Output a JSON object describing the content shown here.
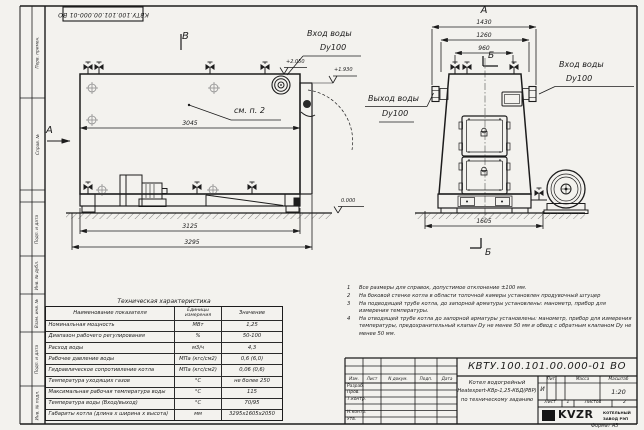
{
  "stamp": {
    "code": "КВТУ.100.101.00.000-01 ВО"
  },
  "margin_labels": {
    "perv_primen": "Перв. примен.",
    "sprav_no": "Справ. №",
    "podp_data1": "Подп. и дата",
    "inv_dubl": "Инв. № дубл.",
    "vzam_inv": "Взам. инв. №",
    "podp_data2": "Подп. и дата",
    "inv_podl": "Инв. № подл."
  },
  "drawing": {
    "view_b_label": "В",
    "view_a_label": "А",
    "view_a_arrow_label": "А",
    "section_label_top": "Б",
    "section_label_bottom": "Б",
    "see_note": "см. п. 2",
    "inlet_label": "Вход воды",
    "inlet_dn": "Dy100",
    "outlet_label": "Выход воды",
    "outlet_dn": "Dy100",
    "inlet2_label": "Вход воды",
    "inlet2_dn": "Dy100",
    "elev_inlet": "+2.050",
    "elev_top": "+1.930",
    "elev_ground": "0.000",
    "dims": {
      "side_flange_length": "3045",
      "side_base_length": "3125",
      "side_total_length": "3295",
      "front_total_width": "1430",
      "front_mid_width": "1260",
      "front_inner_width": "960",
      "front_base_width": "1605"
    }
  },
  "notes": [
    {
      "num": "1",
      "text": "Все размеры для справок, допустимое отклонение ±100 мм."
    },
    {
      "num": "2",
      "text": "На боковой стенке котла в области топочной камеры установлен продувочный штуцер"
    },
    {
      "num": "3",
      "text": "На подводящей трубе котла, до запорной арматуры установлены: манометр, прибор для измерения температуры."
    },
    {
      "num": "4",
      "text": "На отводящей трубе котла до запорной арматуры установлены: манометр, прибор для измерения температуры, предохранительный клапан Dу не менее 50 мм и обвод с обратным клапаном Dу не менее 50 мм."
    }
  ],
  "tech_table": {
    "title": "Техническая характеристика",
    "headers": {
      "name": "Наименование показателя",
      "units": "Единицы измерения",
      "value": "Значение"
    },
    "rows": [
      {
        "name": "Номинальная мощность",
        "units": "МВт",
        "value": "1,25"
      },
      {
        "name": "Диапазон рабочего регулирования",
        "units": "%",
        "value": "50-100"
      },
      {
        "name": "Расход воды",
        "units": "м3/ч",
        "value": "4,3"
      },
      {
        "name": "Рабочее давление воды",
        "units": "МПа (кгс/см2)",
        "value": "0,6 (6,0)"
      },
      {
        "name": "Гидравлическое сопротивление котла",
        "units": "МПа (кгс/см2)",
        "value": "0,06 (0,6)"
      },
      {
        "name": "Температура уходящих газов",
        "units": "°С",
        "value": "не более 250"
      },
      {
        "name": "Максимальная рабочая температура воды",
        "units": "°С",
        "value": "115"
      },
      {
        "name": "Температура воды (Вход/выход)",
        "units": "°С",
        "value": "70/95"
      },
      {
        "name": "Габариты котла (длина х ширина х высота)",
        "units": "мм",
        "value": "3295х1605х2050"
      }
    ]
  },
  "title_block": {
    "doc_number": "КВТУ.100.101.00.000-01 ВО",
    "name_line1": "Котел водогрейный",
    "name_line2": "Heatexpert-КВр-1,25-КБД(РВР)",
    "name_line3": "по техническому заданию",
    "col_izm": "Изм.",
    "col_list": "Лист",
    "col_doc": "N докум.",
    "col_podp": "Подп.",
    "col_data": "Дата",
    "row_razrab": "Разраб.",
    "row_prov": "Пров.",
    "row_tkontr": "Т.контр.",
    "row_nkontr": "Н.контр.",
    "row_utv": "Утв.",
    "lit_label": "Лит.",
    "mass_label": "Масса",
    "scale_label": "Масштаб",
    "lit_value": "И",
    "scale_value": "1:20",
    "sheet_label": "Лист",
    "sheet_value": "1",
    "sheets_label": "Листов",
    "sheets_value": "2",
    "logo_text": "KVZR",
    "logo_sub1": "КОТЕЛЬНЫЙ",
    "logo_sub2": "ЗАВОД РЭП",
    "format_label": "Формат А3"
  }
}
